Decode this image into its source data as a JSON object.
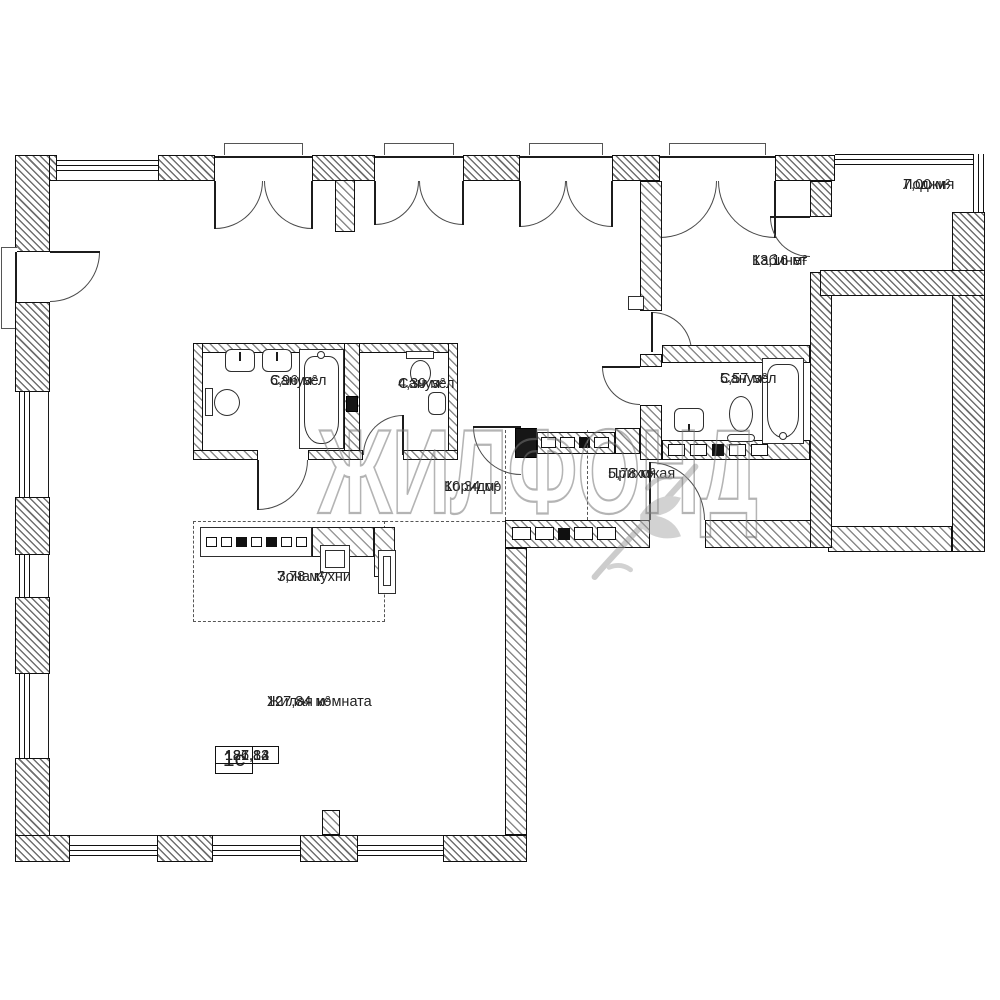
{
  "watermark": {
    "text": "ЖИЛФОНД"
  },
  "rooms": [
    {
      "id": "loggia",
      "name": "Лоджия",
      "area": "7,00 м²"
    },
    {
      "id": "cabinet",
      "name": "Кабинет",
      "area": "13,16 м²"
    },
    {
      "id": "bathroom-large",
      "name": "Санузел",
      "area": "6,96 м²"
    },
    {
      "id": "bathroom-small",
      "name": "Санузел",
      "area": "4,39 м²"
    },
    {
      "id": "bathroom-hall",
      "name": "Санузел",
      "area": "5,57 м²"
    },
    {
      "id": "corridor",
      "name": "Коридор",
      "area": "10,34 м²"
    },
    {
      "id": "hallway",
      "name": "Прихожая",
      "area": "5,78 м²"
    },
    {
      "id": "kitchen-zone",
      "name": "Зона кухни",
      "area": "7,78 м²"
    },
    {
      "id": "living-room",
      "name": "Жилая комната",
      "area": "127,84 м²"
    }
  ],
  "info_table": {
    "type_label": "1с",
    "values": [
      "127,84",
      "181,82",
      "186,13"
    ]
  },
  "colors": {
    "wall_line": "#101010",
    "hatch": "#6f6f6f",
    "watermark_gray": "#767676",
    "dash": "#565656",
    "text": "#222222"
  }
}
